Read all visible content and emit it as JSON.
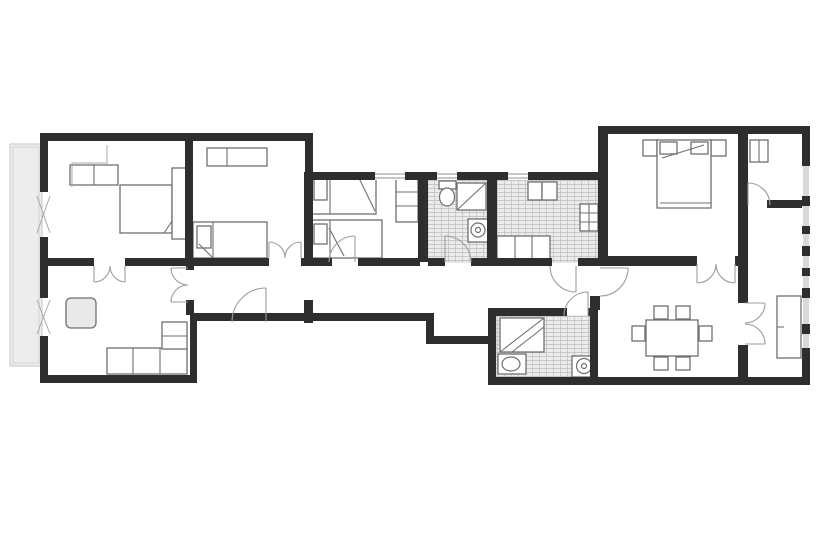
{
  "canvas": {
    "width": 820,
    "height": 560
  },
  "palette": {
    "background": "#ffffff",
    "wall": "#2e2e2e",
    "furniture_stroke": "#6f6f6f",
    "light_stroke": "#a8a8a8",
    "door_stroke": "#9d9d9d",
    "tile_fill": "#ececec",
    "tile_line": "#bdbdbd",
    "balcony_fill": "#ededed",
    "balcony_stroke": "#c6c6c6",
    "window_glass": "#d9d9d9",
    "table_fill": "#e9e9e9",
    "window_line": "#8f8f8f"
  },
  "balcony": {
    "name": "balcony",
    "rect": [
      10,
      144,
      32,
      222
    ]
  },
  "window_band": {
    "name": "window-band-right-facade",
    "rect": [
      803,
      166,
      6,
      190
    ]
  },
  "tiles": [
    {
      "name": "tile-floor-bathroom-1",
      "rect": [
        428,
        180,
        59,
        82
      ]
    },
    {
      "name": "tile-floor-kitchen",
      "rect": [
        497,
        180,
        101,
        82
      ]
    },
    {
      "name": "tile-floor-bathroom-2",
      "rect": [
        496,
        316,
        94,
        61
      ]
    }
  ],
  "walls": [
    [
      40,
      133,
      273,
      8
    ],
    [
      305,
      133,
      8,
      45
    ],
    [
      40,
      133,
      8,
      59
    ],
    [
      40,
      237,
      8,
      61
    ],
    [
      40,
      336,
      8,
      47
    ],
    [
      40,
      375,
      157,
      8
    ],
    [
      185,
      137,
      8,
      121
    ],
    [
      47,
      258,
      47,
      8
    ],
    [
      125,
      258,
      144,
      8
    ],
    [
      301,
      258,
      11,
      8
    ],
    [
      186,
      258,
      8,
      12
    ],
    [
      186,
      300,
      8,
      15
    ],
    [
      304,
      172,
      9,
      94
    ],
    [
      304,
      300,
      9,
      23
    ],
    [
      190,
      313,
      7,
      70
    ],
    [
      190,
      313,
      243,
      8
    ],
    [
      426,
      313,
      8,
      31
    ],
    [
      426,
      336,
      67,
      8
    ],
    [
      313,
      172,
      62,
      8
    ],
    [
      405,
      172,
      32,
      8
    ],
    [
      457,
      172,
      51,
      8
    ],
    [
      528,
      172,
      70,
      8
    ],
    [
      418,
      172,
      10,
      90
    ],
    [
      487,
      172,
      10,
      90
    ],
    [
      313,
      258,
      19,
      8
    ],
    [
      358,
      258,
      62,
      8
    ],
    [
      428,
      258,
      17,
      8
    ],
    [
      471,
      258,
      28,
      8
    ],
    [
      497,
      258,
      55,
      8
    ],
    [
      578,
      258,
      30,
      8
    ],
    [
      598,
      126,
      10,
      140
    ],
    [
      590,
      296,
      10,
      14
    ],
    [
      488,
      308,
      8,
      69
    ],
    [
      488,
      308,
      79,
      8
    ],
    [
      588,
      308,
      10,
      8
    ],
    [
      590,
      308,
      8,
      69
    ],
    [
      488,
      377,
      322,
      8
    ],
    [
      598,
      126,
      212,
      8
    ],
    [
      802,
      126,
      8,
      40
    ],
    [
      802,
      196,
      8,
      10
    ],
    [
      802,
      226,
      8,
      8
    ],
    [
      802,
      246,
      8,
      10
    ],
    [
      802,
      268,
      8,
      8
    ],
    [
      802,
      288,
      8,
      10
    ],
    [
      802,
      324,
      8,
      10
    ],
    [
      802,
      348,
      8,
      8
    ],
    [
      802,
      356,
      8,
      29
    ],
    [
      598,
      256,
      99,
      10
    ],
    [
      735,
      256,
      11,
      10
    ],
    [
      738,
      133,
      10,
      170
    ],
    [
      738,
      345,
      10,
      32
    ],
    [
      767,
      200,
      35,
      8
    ]
  ],
  "windows": [
    {
      "name": "window-bedroom-3",
      "rect": [
        375,
        172,
        30,
        8
      ]
    },
    {
      "name": "window-bathroom-1",
      "rect": [
        437,
        172,
        20,
        8
      ]
    },
    {
      "name": "window-kitchen",
      "rect": [
        508,
        172,
        20,
        8
      ]
    }
  ],
  "furniture": [
    {
      "name": "wardrobe-bedroom-1",
      "rect": [
        70,
        165,
        48,
        20
      ]
    },
    {
      "name": "bed-bedroom-1",
      "rect": [
        120,
        185,
        52,
        48
      ]
    },
    {
      "name": "headboard-bedroom-1",
      "rect": [
        172,
        168,
        15,
        71
      ]
    },
    {
      "name": "desk-bedroom-2",
      "rect": [
        207,
        148,
        60,
        18
      ]
    },
    {
      "name": "bed-bedroom-2",
      "rect": [
        193,
        222,
        74,
        36
      ]
    },
    {
      "name": "pillow-bedroom-2",
      "rect": [
        197,
        226,
        14,
        22
      ]
    },
    {
      "name": "bed-a-bedroom-3",
      "rect": [
        312,
        174,
        64,
        40
      ]
    },
    {
      "name": "pillow-bed-a",
      "rect": [
        314,
        178,
        13,
        22
      ]
    },
    {
      "name": "bed-b-bedroom-3",
      "rect": [
        312,
        220,
        70,
        38
      ]
    },
    {
      "name": "pillow-bed-b",
      "rect": [
        314,
        224,
        13,
        20
      ]
    },
    {
      "name": "wardrobe-bedroom-3",
      "rect": [
        396,
        174,
        22,
        48
      ]
    },
    {
      "name": "toilet-tank-bathroom-1",
      "rect": [
        439,
        181,
        17,
        8
      ]
    },
    {
      "name": "shower-bathroom-1",
      "rect": [
        457,
        183,
        29,
        27
      ]
    },
    {
      "name": "washing-machine",
      "rect": [
        468,
        219,
        20,
        23
      ]
    },
    {
      "name": "kitchen-sink-left",
      "rect": [
        528,
        182,
        14,
        18
      ]
    },
    {
      "name": "kitchen-sink-right",
      "rect": [
        542,
        182,
        15,
        18
      ]
    },
    {
      "name": "stove",
      "rect": [
        580,
        204,
        18,
        27
      ]
    },
    {
      "name": "kitchen-counter",
      "rect": [
        497,
        236,
        53,
        25
      ]
    },
    {
      "name": "shower-bathroom-2",
      "rect": [
        500,
        318,
        44,
        34
      ]
    },
    {
      "name": "sink-bathroom-2",
      "rect": [
        498,
        354,
        28,
        20
      ]
    },
    {
      "name": "toilet-bathroom-2",
      "rect": [
        572,
        356,
        24,
        21
      ]
    },
    {
      "name": "dining-table",
      "rect": [
        646,
        320,
        52,
        36
      ]
    },
    {
      "name": "chair",
      "rect": [
        654,
        306,
        14,
        13
      ]
    },
    {
      "name": "chair",
      "rect": [
        676,
        306,
        14,
        13
      ]
    },
    {
      "name": "chair",
      "rect": [
        654,
        357,
        14,
        13
      ]
    },
    {
      "name": "chair",
      "rect": [
        676,
        357,
        14,
        13
      ]
    },
    {
      "name": "chair",
      "rect": [
        632,
        326,
        13,
        15
      ]
    },
    {
      "name": "chair",
      "rect": [
        699,
        326,
        13,
        15
      ]
    },
    {
      "name": "nightstand-left-bedroom-4",
      "rect": [
        643,
        140,
        14,
        16
      ]
    },
    {
      "name": "nightstand-right-bedroom-4",
      "rect": [
        711,
        140,
        15,
        16
      ]
    },
    {
      "name": "bed-bedroom-4",
      "rect": [
        657,
        140,
        54,
        68
      ]
    },
    {
      "name": "pillow-bed-4-left",
      "rect": [
        660,
        142,
        17,
        12
      ]
    },
    {
      "name": "pillow-bed-4-right",
      "rect": [
        691,
        142,
        17,
        12
      ]
    },
    {
      "name": "closet-passage",
      "rect": [
        750,
        140,
        18,
        22
      ]
    },
    {
      "name": "sideboard-right-room",
      "rect": [
        777,
        296,
        24,
        62
      ]
    },
    {
      "name": "coffee-table-living",
      "rect": [
        66,
        298,
        30,
        30
      ],
      "fill": "table",
      "rx": 5
    },
    {
      "name": "sofa-living",
      "rect": [
        107,
        348,
        80,
        26
      ]
    },
    {
      "name": "sofa-living-corner",
      "rect": [
        162,
        322,
        25,
        27
      ]
    }
  ],
  "furniture_lines": [
    {
      "name": "bed-1-fold",
      "pts": [
        172,
        221,
        164,
        233
      ]
    },
    {
      "name": "desk-2-divider",
      "pts": [
        227,
        148,
        227,
        166
      ]
    },
    {
      "name": "bed-2-headline",
      "pts": [
        213,
        222,
        213,
        258
      ]
    },
    {
      "name": "bed-2-fold",
      "pts": [
        199,
        244,
        212,
        257
      ]
    },
    {
      "name": "bed-a-headline",
      "pts": [
        330,
        174,
        330,
        214
      ]
    },
    {
      "name": "bed-a-fold",
      "pts": [
        358,
        176,
        375,
        211
      ]
    },
    {
      "name": "bed-b-headline",
      "pts": [
        330,
        220,
        330,
        258
      ]
    },
    {
      "name": "bed-b-fold",
      "pts": [
        329,
        228,
        344,
        256
      ]
    },
    {
      "name": "wardrobe-3-shelf-1",
      "pts": [
        396,
        192,
        418,
        192
      ]
    },
    {
      "name": "wardrobe-3-shelf-2",
      "pts": [
        396,
        206,
        418,
        206
      ]
    },
    {
      "name": "wardrobe-1-divider",
      "pts": [
        94,
        165,
        94,
        185
      ]
    },
    {
      "name": "shower-1-diagonal",
      "pts": [
        457,
        210,
        486,
        183
      ]
    },
    {
      "name": "stove-divider-v",
      "pts": [
        589,
        204,
        589,
        231
      ]
    },
    {
      "name": "stove-divider-h1",
      "pts": [
        580,
        213,
        598,
        213
      ]
    },
    {
      "name": "stove-divider-h2",
      "pts": [
        580,
        222,
        598,
        222
      ]
    },
    {
      "name": "counter-div-1",
      "pts": [
        515,
        236,
        515,
        261
      ]
    },
    {
      "name": "counter-div-2",
      "pts": [
        532,
        236,
        532,
        261
      ]
    },
    {
      "name": "shower-2-diagonal",
      "pts": [
        500,
        352,
        544,
        318
      ]
    },
    {
      "name": "shower-2-diagonal-2",
      "pts": [
        512,
        352,
        544,
        327
      ]
    },
    {
      "name": "bed-4-fold",
      "pts": [
        662,
        158,
        704,
        145
      ]
    },
    {
      "name": "bed-4-footline",
      "pts": [
        660,
        203,
        711,
        203
      ]
    },
    {
      "name": "closet-passage-divider",
      "pts": [
        759,
        140,
        759,
        162
      ]
    },
    {
      "name": "sideboard-tick",
      "pts": [
        777,
        327,
        784,
        327
      ]
    },
    {
      "name": "sofa-div-1",
      "pts": [
        133,
        348,
        133,
        374
      ]
    },
    {
      "name": "sofa-div-2",
      "pts": [
        160,
        348,
        160,
        374
      ]
    },
    {
      "name": "sofa-corner-div",
      "pts": [
        162,
        336,
        187,
        336
      ]
    }
  ],
  "ellipses": [
    {
      "name": "toilet-bowl-bathroom-1",
      "c": [
        447,
        197,
        7.5,
        9
      ]
    },
    {
      "name": "washer-drum",
      "c": [
        478,
        230,
        7,
        7
      ]
    },
    {
      "name": "washer-dot",
      "c": [
        478,
        230,
        2.5,
        2.5
      ]
    },
    {
      "name": "sink-bowl-bathroom-2",
      "c": [
        511,
        364,
        9,
        7
      ]
    },
    {
      "name": "toilet-bowl-bathroom-2",
      "c": [
        584,
        366,
        7.5,
        7.5
      ]
    },
    {
      "name": "toilet-dot-bathroom-2",
      "c": [
        584,
        366,
        2.5,
        2.5
      ]
    }
  ],
  "light_paths": [
    {
      "name": "closet-step-bedroom-1",
      "d": "M72,187 L72,163 L107,163 L107,145"
    },
    {
      "name": "casement-window-bedroom-1",
      "d": "M37,196 L50,233 M50,196 L37,233"
    },
    {
      "name": "casement-window-living",
      "d": "M37,300 L50,334 M50,300 L37,334"
    }
  ],
  "doors": [
    {
      "name": "double-door-living-bedroom1-arc-l",
      "d": "M110,266 A16,16 0 0 1 94,282"
    },
    {
      "name": "double-door-living-bedroom1-arc-r",
      "d": "M110,266 A16,16 0 0 0 125,282"
    },
    {
      "name": "double-door-living-bedroom1-leaf-l",
      "d": "M94,266 L94,282"
    },
    {
      "name": "double-door-living-bedroom1-leaf-r",
      "d": "M125,266 L125,282"
    },
    {
      "name": "double-door-bedroom2-arc-l",
      "d": "M285,258 A16,16 0 0 0 269,242"
    },
    {
      "name": "double-door-bedroom2-arc-r",
      "d": "M285,258 A16,16 0 0 1 301,242"
    },
    {
      "name": "double-door-bedroom2-leaf-l",
      "d": "M269,258 L269,242"
    },
    {
      "name": "double-door-bedroom2-leaf-r",
      "d": "M301,258 L301,242"
    },
    {
      "name": "double-door-living-hall-arc-t",
      "d": "M171,268 A17,17 0 0 0 188,285"
    },
    {
      "name": "double-door-living-hall-arc-b",
      "d": "M171,302 A17,17 0 0 1 188,285"
    },
    {
      "name": "double-door-living-hall-leaf-t",
      "d": "M188,268 L171,268"
    },
    {
      "name": "double-door-living-hall-leaf-b",
      "d": "M188,302 L171,302"
    },
    {
      "name": "hall-door-arc",
      "d": "M266,288 A34,34 0 0 0 232,322"
    },
    {
      "name": "hall-door-leaf",
      "d": "M266,322 L266,288"
    },
    {
      "name": "bedroom3-door-arc",
      "d": "M355,236 A26,26 0 0 0 329,262"
    },
    {
      "name": "bedroom3-door-leaf",
      "d": "M355,262 L355,236"
    },
    {
      "name": "bathroom1-door-arc",
      "d": "M445,236 A26,26 0 0 1 471,262"
    },
    {
      "name": "bathroom1-door-leaf",
      "d": "M445,262 L445,236"
    },
    {
      "name": "kitchen-door-arc",
      "d": "M550,266 A26,26 0 0 0 576,292"
    },
    {
      "name": "kitchen-door-leaf",
      "d": "M576,266 L576,292"
    },
    {
      "name": "bathroom2-door-arc",
      "d": "M588,292 A24,24 0 0 0 564,316"
    },
    {
      "name": "bathroom2-door-leaf",
      "d": "M588,316 L588,292"
    },
    {
      "name": "dining-entry-door-arc",
      "d": "M628,268 A28,28 0 0 1 600,296"
    },
    {
      "name": "dining-entry-door-leaf",
      "d": "M600,268 L628,268"
    },
    {
      "name": "double-door-dining-arc-l",
      "d": "M716,264 A19,19 0 0 1 697,283"
    },
    {
      "name": "double-door-dining-arc-r",
      "d": "M716,264 A19,19 0 0 0 735,283"
    },
    {
      "name": "double-door-dining-leaf-l",
      "d": "M697,264 L697,283"
    },
    {
      "name": "double-door-dining-leaf-r",
      "d": "M735,264 L735,283"
    },
    {
      "name": "double-door-rightroom-arc-t",
      "d": "M765,303 A20,20 0 0 1 745,323"
    },
    {
      "name": "double-door-rightroom-arc-b",
      "d": "M765,344 A20,20 0 0 0 745,324"
    },
    {
      "name": "double-door-rightroom-leaf-t",
      "d": "M745,303 L765,303"
    },
    {
      "name": "double-door-rightroom-leaf-b",
      "d": "M745,344 L765,344"
    },
    {
      "name": "passage-door-arc",
      "d": "M748,183 A22,22 0 0 1 770,205"
    },
    {
      "name": "passage-door-leaf",
      "d": "M748,205 L748,183"
    }
  ],
  "rooms": [
    {
      "name": "room-bedroom-1",
      "rect": [
        48,
        141,
        137,
        117
      ]
    },
    {
      "name": "room-bedroom-2",
      "rect": [
        193,
        141,
        111,
        117
      ]
    },
    {
      "name": "room-living",
      "rect": [
        48,
        266,
        138,
        109
      ]
    },
    {
      "name": "room-bedroom-3",
      "rect": [
        313,
        180,
        105,
        78
      ]
    },
    {
      "name": "room-bathroom-1",
      "rect": [
        428,
        180,
        59,
        78
      ]
    },
    {
      "name": "room-kitchen",
      "rect": [
        497,
        180,
        101,
        78
      ]
    },
    {
      "name": "room-hallway",
      "rect": [
        197,
        266,
        401,
        47
      ]
    },
    {
      "name": "room-bathroom-2",
      "rect": [
        496,
        316,
        94,
        61
      ]
    },
    {
      "name": "room-dining",
      "rect": [
        608,
        266,
        130,
        111
      ]
    },
    {
      "name": "room-bedroom-4",
      "rect": [
        608,
        138,
        130,
        118
      ]
    },
    {
      "name": "room-entry-passage",
      "rect": [
        748,
        138,
        54,
        62
      ]
    },
    {
      "name": "room-study",
      "rect": [
        748,
        208,
        54,
        169
      ]
    }
  ]
}
